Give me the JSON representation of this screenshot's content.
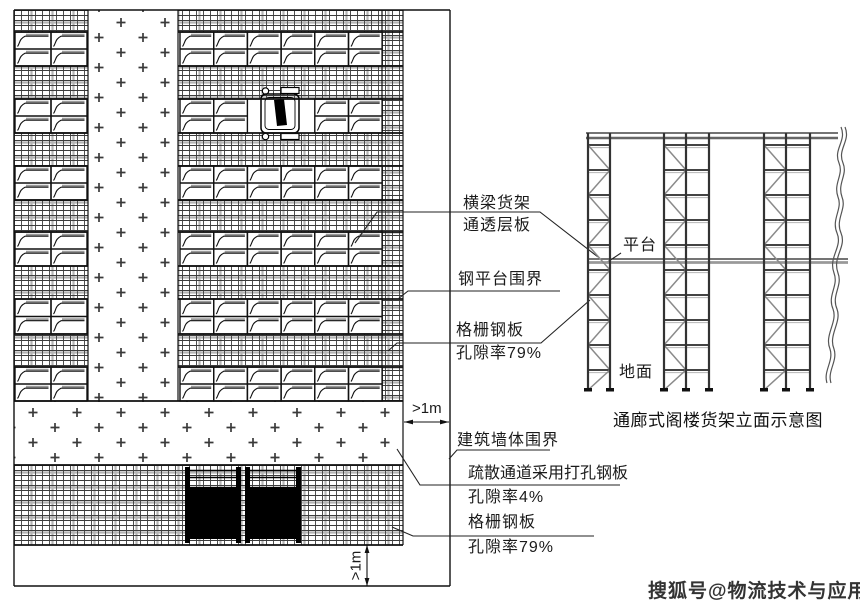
{
  "plan": {
    "callouts": {
      "beam_rack": {
        "line1": "横梁货架",
        "line2": "通透层板"
      },
      "steel_platform_boundary": "钢平台围界",
      "grating_plate_upper": {
        "line1": "格栅钢板",
        "line2": "孔隙率79%"
      },
      "building_wall_boundary": "建筑墙体围界",
      "evacuation_channel": {
        "line1": "疏散通道采用打孔钢板",
        "line2": "孔隙率4%"
      },
      "grating_plate_lower": {
        "line1": "格栅钢板",
        "line2": "孔隙率79%"
      },
      "dim_side_clearance": ">1m",
      "dim_bottom_clearance": ">1m"
    }
  },
  "elevation": {
    "platform_label": "平台",
    "ground_label": "地面",
    "caption": "通廊式阁楼货架立面示意图"
  },
  "watermark": "搜狐号@物流技术与应用",
  "colors": {
    "line": "#1a1a1a",
    "accent_gray": "#999999",
    "watermark": "#333333"
  }
}
